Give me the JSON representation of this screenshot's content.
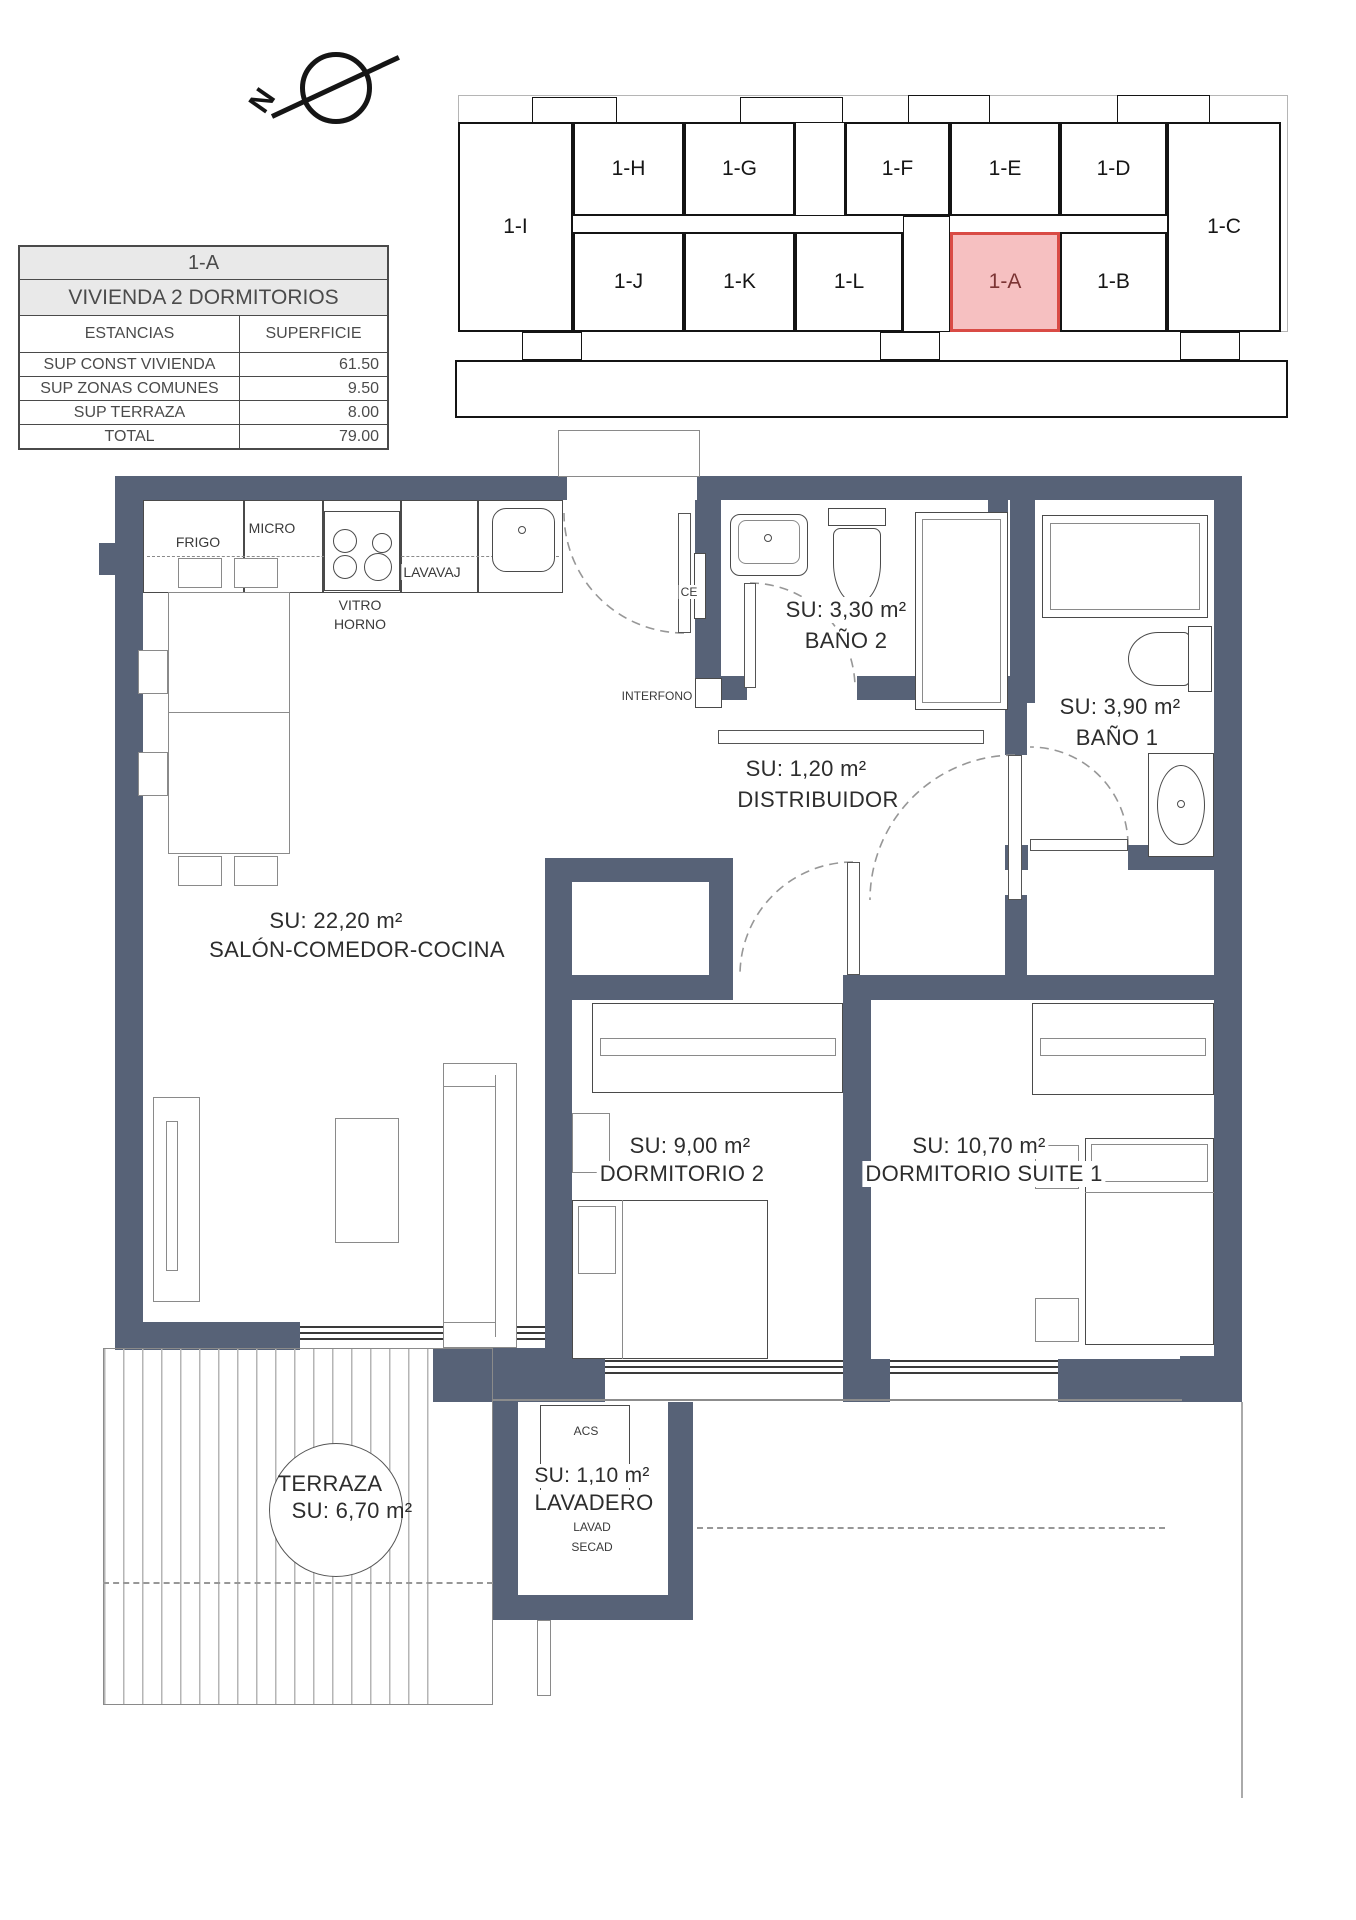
{
  "info_table": {
    "title": "1-A",
    "subtitle": "VIVIENDA 2 DORMITORIOS",
    "columns": {
      "estancias": "ESTANCIAS",
      "superficie": "SUPERFICIE"
    },
    "rows": [
      {
        "label": "SUP CONST VIVIENDA",
        "value": "61.50"
      },
      {
        "label": "SUP ZONAS COMUNES",
        "value": "9.50"
      },
      {
        "label": "SUP TERRAZA",
        "value": "8.00"
      },
      {
        "label": "TOTAL",
        "value": "79.00"
      }
    ]
  },
  "compass": {
    "north_label": "N"
  },
  "key_plan": {
    "highlighted_unit": "1-A",
    "highlight_border": "#d94b45",
    "highlight_fill": "#f6c0c1",
    "units": {
      "i": "1-I",
      "h": "1-H",
      "g": "1-G",
      "f": "1-F",
      "e": "1-E",
      "d": "1-D",
      "c": "1-C",
      "j": "1-J",
      "k": "1-K",
      "l": "1-L",
      "a": "1-A",
      "b": "1-B"
    }
  },
  "rooms": {
    "salon": {
      "area": "SU: 22,20 m²",
      "name": "SALÓN-COMEDOR-COCINA"
    },
    "bano2": {
      "area": "SU: 3,30 m²",
      "name": "BAÑO 2"
    },
    "bano1": {
      "area": "SU: 3,90 m²",
      "name": "BAÑO 1"
    },
    "distribuidor": {
      "area": "SU: 1,20 m²",
      "name": "DISTRIBUIDOR"
    },
    "dormitorio2": {
      "area": "SU: 9,00 m²",
      "name": "DORMITORIO 2"
    },
    "suite": {
      "area": "SU: 10,70 m²",
      "name": "DORMITORIO SUITE 1"
    },
    "terraza": {
      "name": "TERRAZA",
      "area": "SU: 6,70 m²"
    },
    "lavadero": {
      "area": "SU: 1,10 m²",
      "name": "LAVADERO",
      "sub1": "LAVAD",
      "sub2": "SECAD"
    }
  },
  "kitchen_labels": {
    "frigo": "FRIGO",
    "micro": "MICRO",
    "lavavaj": "LAVAVAJ",
    "vitro": "VITRO",
    "horno": "HORNO"
  },
  "entry_labels": {
    "ce": "CE",
    "interfono": "INTERFONO"
  },
  "lavadero_labels": {
    "acs": "ACS"
  },
  "colors": {
    "wall": "#576277",
    "highlight": "#d94b45"
  }
}
